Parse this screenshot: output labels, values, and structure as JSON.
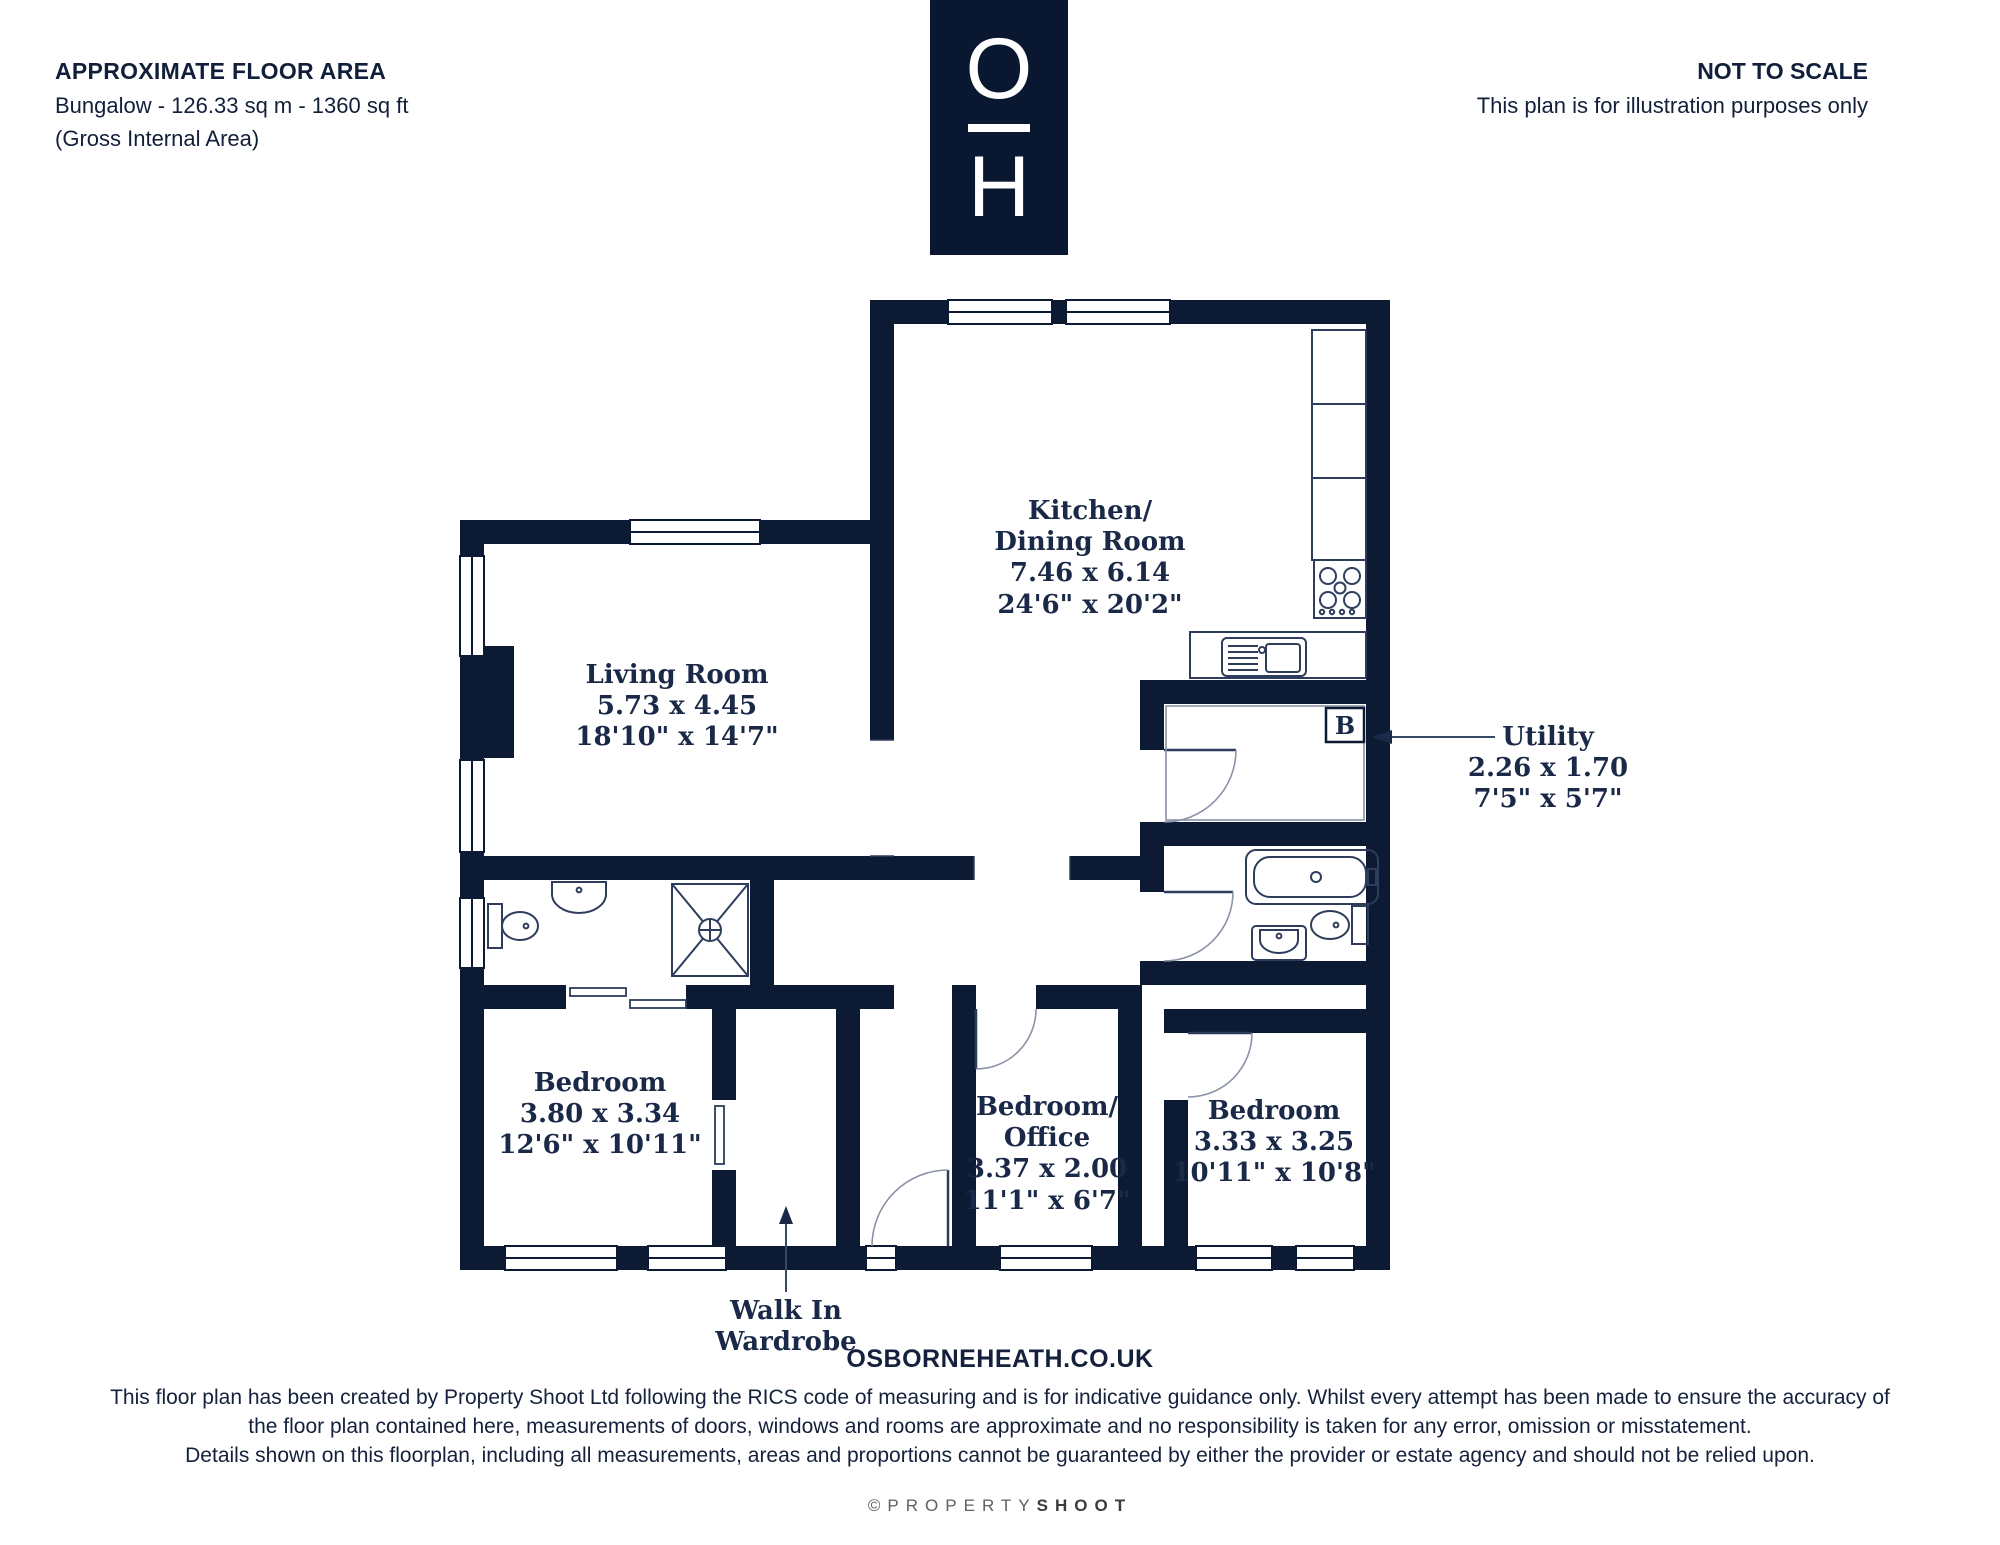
{
  "colors": {
    "wall": "#0c1a33",
    "label_text": "#1a2947",
    "fixture_line": "#2e3d5c",
    "arc_line": "#8a93a6",
    "credit_gray": "#5f5f5f"
  },
  "header": {
    "floor_area": {
      "title": "APPROXIMATE FLOOR AREA",
      "line1": "Bungalow - 126.33 sq m - 1360 sq ft",
      "line2": "(Gross Internal Area)"
    },
    "logo": {
      "top": "O",
      "bottom": "H"
    },
    "scale": {
      "title": "NOT TO SCALE",
      "subtitle": "This plan is for illustration purposes only"
    }
  },
  "rooms": {
    "kitchen": {
      "line1": "Kitchen/",
      "line2": "Dining Room",
      "metric": "7.46 x 6.14",
      "imperial": "24'6\" x 20'2\""
    },
    "living": {
      "line1": "Living Room",
      "line2": "",
      "metric": "5.73 x 4.45",
      "imperial": "18'10\" x 14'7\""
    },
    "utility": {
      "line1": "Utility",
      "line2": "",
      "metric": "2.26 x 1.70",
      "imperial": "7'5\" x 5'7\""
    },
    "bedroom1": {
      "line1": "Bedroom",
      "line2": "",
      "metric": "3.80 x 3.34",
      "imperial": "12'6\" x 10'11\""
    },
    "bedroom_office": {
      "line1": "Bedroom/",
      "line2": "Office",
      "metric": "3.37 x 2.00",
      "imperial": "11'1\" x 6'7\""
    },
    "bedroom2": {
      "line1": "Bedroom",
      "line2": "",
      "metric": "3.33 x 3.25",
      "imperial": "10'11\" x 10'8\""
    },
    "wardrobe": {
      "line1": "Walk In",
      "line2": "Wardrobe"
    }
  },
  "annotations": {
    "boiler": "B"
  },
  "footer": {
    "website": "OSBORNEHEATH.CO.UK",
    "disclaimer1": "This floor plan has been created by Property Shoot Ltd following the RICS code of measuring and is for indicative guidance only. Whilst every attempt has been made to ensure the accuracy of",
    "disclaimer2": "the floor plan contained here, measurements of doors, windows and rooms are approximate and no responsibility is taken for any error, omission or misstatement.",
    "disclaimer3": "Details shown on this floorplan, including all measurements, areas and proportions cannot be guaranteed by either the provider or estate agency and should not be relied upon.",
    "credit_symbol": "©",
    "credit_light": "PROPERTY",
    "credit_bold": "SHOOT"
  }
}
